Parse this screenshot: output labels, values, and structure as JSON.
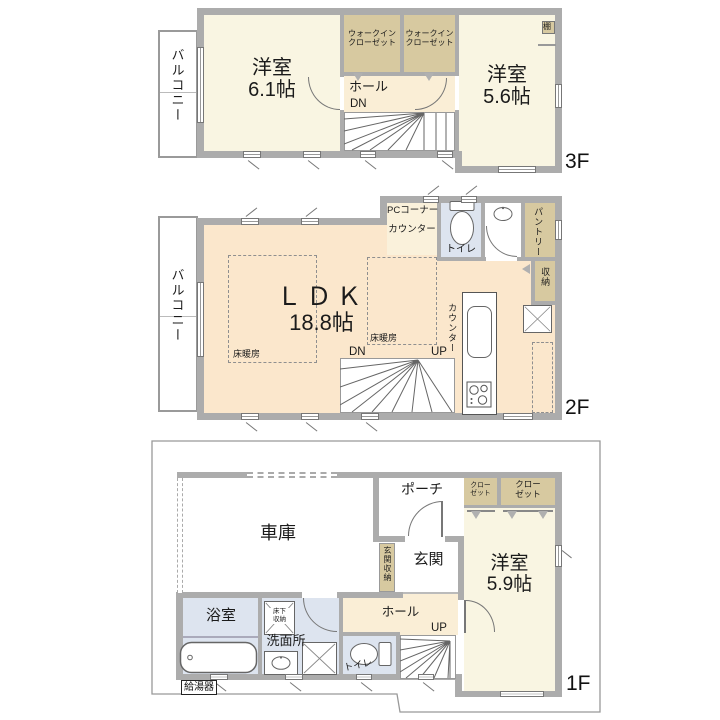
{
  "palette": {
    "wall": "#ACACAC",
    "room_cream": "#F9F5E2",
    "hall_cream": "#FAEED6",
    "ldk_peach": "#FBE7CC",
    "closet_tan": "#D7C9A0",
    "sanitary_blue": "#DDE4EF",
    "outline_gray": "#999999"
  },
  "f3": {
    "floor_label": "3F",
    "balcony": "バルコニー",
    "room61_name": "洋室",
    "room61_size": "6.1帖",
    "wic1_l1": "ウォークイン",
    "wic1_l2": "クローゼット",
    "wic2_l1": "ウォークイン",
    "wic2_l2": "クローゼット",
    "hall": "ホール",
    "dn": "DN",
    "shelf": "棚",
    "room56_name": "洋室",
    "room56_size": "5.6帖"
  },
  "f2": {
    "floor_label": "2F",
    "balcony": "バルコニー",
    "ldk_name": "ＬＤＫ",
    "ldk_size": "18.8帖",
    "heating_left": "床暖房",
    "heating_right": "床暖房",
    "pc_corner": "PCコーナー",
    "pc_counter": "カウンター",
    "toilet": "トイレ",
    "pantry": "パントリー",
    "storage": "収納",
    "kitchen_counter": "カウンター",
    "dn": "DN",
    "up": "UP"
  },
  "f1": {
    "floor_label": "1F",
    "garage": "車庫",
    "porch": "ポーチ",
    "entrance": "玄関",
    "entrance_storage": "玄関収納",
    "hall": "ホール",
    "up": "UP",
    "closet1_l1": "クロー",
    "closet1_l2": "ゼット",
    "closet2_l1": "クロー",
    "closet2_l2": "ゼット",
    "room59_name": "洋室",
    "room59_size": "5.9帖",
    "bathroom": "浴室",
    "underfloor_l1": "床下",
    "underfloor_l2": "収納",
    "washroom": "洗面所",
    "toilet": "トイレ",
    "water_heater": "給湯器"
  }
}
